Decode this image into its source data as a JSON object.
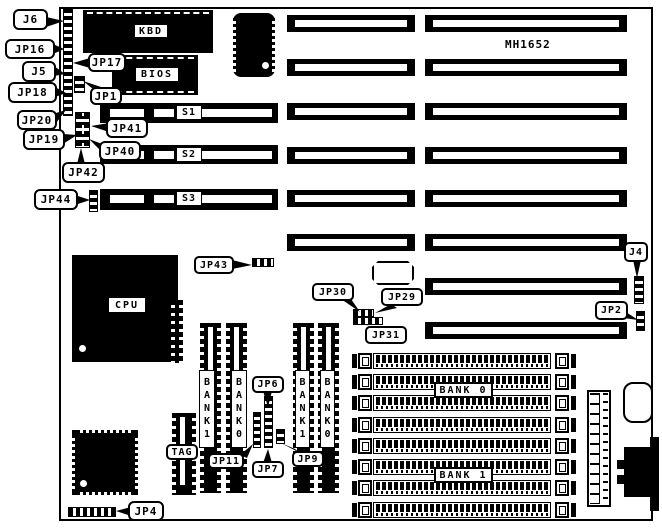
{
  "board": {
    "model": "MH1652",
    "labels": {
      "kbd": "KBD",
      "bios": "BIOS",
      "cpu": "CPU",
      "tag": "TAG",
      "s1": "S1",
      "s2": "S2",
      "s3": "S3",
      "simm_bank0": "BANK 0",
      "simm_bank1": "BANK 1",
      "cache_bank0": "BANK0",
      "cache_bank1": "BANK1"
    },
    "callouts": {
      "j6": "J6",
      "jp16": "JP16",
      "j5": "J5",
      "jp18": "JP18",
      "jp20": "JP20",
      "jp19": "JP19",
      "jp42": "JP42",
      "jp44": "JP44",
      "jp17": "JP17",
      "jp1": "JP1",
      "jp41": "JP41",
      "jp40": "JP40",
      "jp43": "JP43",
      "jp30": "JP30",
      "jp29": "JP29",
      "jp31": "JP31",
      "j4": "J4",
      "jp2": "JP2",
      "jp6": "JP6",
      "jp7": "JP7",
      "jp11": "JP11",
      "jp9": "JP9",
      "jp4": "JP4"
    },
    "colors": {
      "ink": "#000000",
      "paper": "#ffffff"
    }
  }
}
